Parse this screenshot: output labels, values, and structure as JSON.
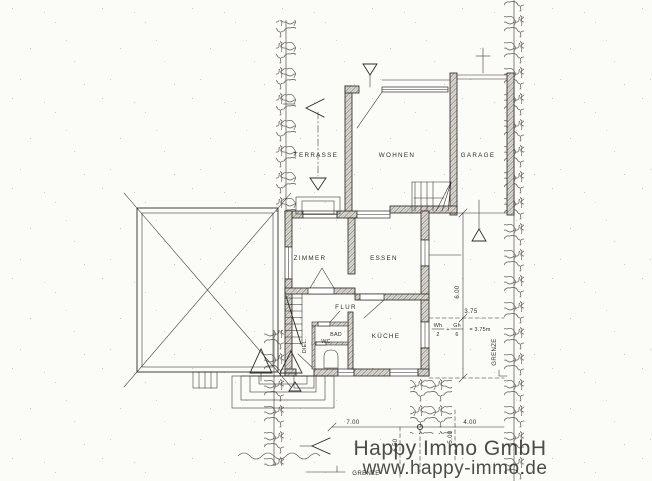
{
  "colors": {
    "paper": "#fbfbf8",
    "ink": "#2e2d2b",
    "hatch": "#98948c",
    "hatchbg": "#e8e5df",
    "hedge": "#6b6862",
    "wm": "#333333"
  },
  "rooms": {
    "terrasse": "TERRASSE",
    "wohnen": "WOHNEN",
    "garage": "GARAGE",
    "zimmer": "ZIMMER",
    "essen": "ESSEN",
    "flur": "FLUR",
    "bad": "BAD",
    "wc": "WC",
    "kueche": "KÜCHE",
    "diele": "DIEL."
  },
  "dimensions": {
    "east_length": "6.00",
    "east_setback": "3.75",
    "south_left": "7.00",
    "south_right": "4.00",
    "south_depth_left": "6.50",
    "south_depth_right": "5.00",
    "formula": {
      "num1": "Wh",
      "den1": "2",
      "plus": "+",
      "num2": "Gh",
      "den2": "6",
      "result": "= 3.75m"
    }
  },
  "boundary": {
    "grenze_east": "GRENZE",
    "grenze_south": "GRENZE"
  },
  "watermark": {
    "line1": "Happy Immo GmbH",
    "line2": "www.happy-immo.de"
  }
}
